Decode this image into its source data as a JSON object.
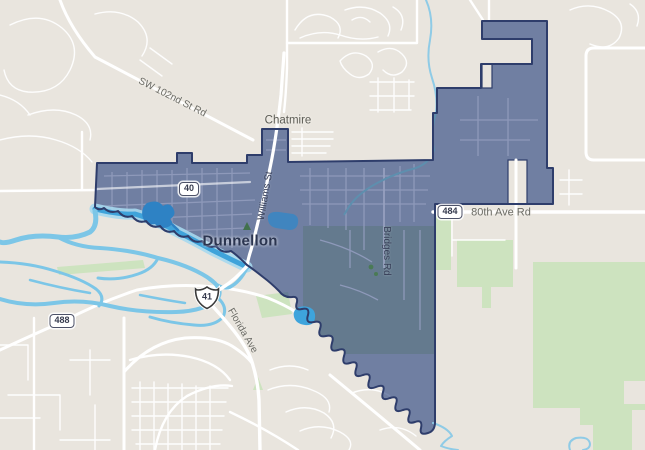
{
  "map": {
    "city": {
      "label": "Dunnellon"
    },
    "places": [
      {
        "label": "Chatmire"
      }
    ],
    "streets": [
      {
        "label": "SW 102nd St Rd"
      },
      {
        "label": "Williams St"
      },
      {
        "label": "Bridges Rd"
      },
      {
        "label": "80th Ave Rd"
      },
      {
        "label": "Florida Ave"
      }
    ],
    "route_shields": [
      {
        "type": "state-rect",
        "number": "40"
      },
      {
        "type": "us-shield",
        "number": "41"
      },
      {
        "type": "state-rect",
        "number": "484"
      },
      {
        "type": "state-rect",
        "number": "488"
      }
    ],
    "colors": {
      "land": "#e9e5de",
      "park_green": "#cde3bf",
      "water_blue": "#7cc6e7",
      "water_deep": "#3fa3da",
      "boundary_fill": "#1f3a7a",
      "boundary_stroke": "#2e3d6b",
      "road_white": "#ffffff",
      "label_gray": "#6a6a64",
      "city_label_color": "#2b3550"
    }
  }
}
